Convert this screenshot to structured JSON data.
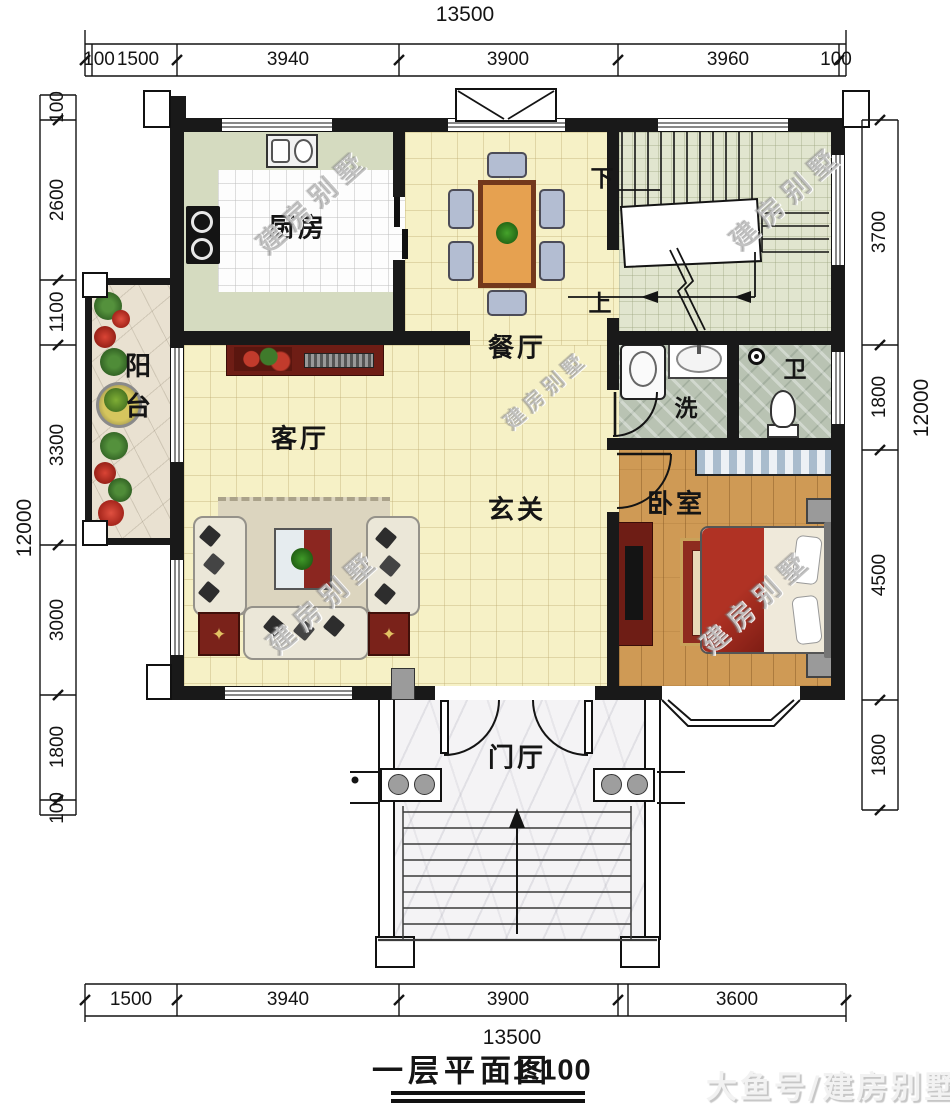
{
  "title": {
    "text": "一层平面图",
    "scale": "1:100"
  },
  "watermarks": {
    "diagonal": "建房别墅",
    "corner": "大鱼号/建房别墅"
  },
  "rooms": {
    "kitchen": "厨房",
    "dining": "餐厅",
    "living": "客厅",
    "hall": "玄关",
    "balcony": "阳台",
    "wash": "洗",
    "toilet": "卫",
    "bedroom": "卧室",
    "foyer": "门厅",
    "stairs_up": "上",
    "stairs_down": "下"
  },
  "dimensions": {
    "top_total": "13500",
    "top": [
      "100",
      "1500",
      "3940",
      "3900",
      "3960",
      "100"
    ],
    "bottom": [
      "1500",
      "3940",
      "3900",
      "3600"
    ],
    "bottom_total": "13500",
    "left": [
      "100",
      "2600",
      "1100",
      "3300",
      "3000",
      "1800",
      "100"
    ],
    "left_total": "12000",
    "right": [
      "3700",
      "1800",
      "4500",
      "1800"
    ],
    "right_total": "12000"
  },
  "colors": {
    "wall": "#191919",
    "tile_yellow": "#f6f1c6",
    "stair_floor": "#e1e5cf",
    "bath_stone": "#b9c3b3",
    "bedroom_wood": "#cf9a55",
    "table_orange": "#e6a150",
    "accent_red": "#7a221a"
  }
}
